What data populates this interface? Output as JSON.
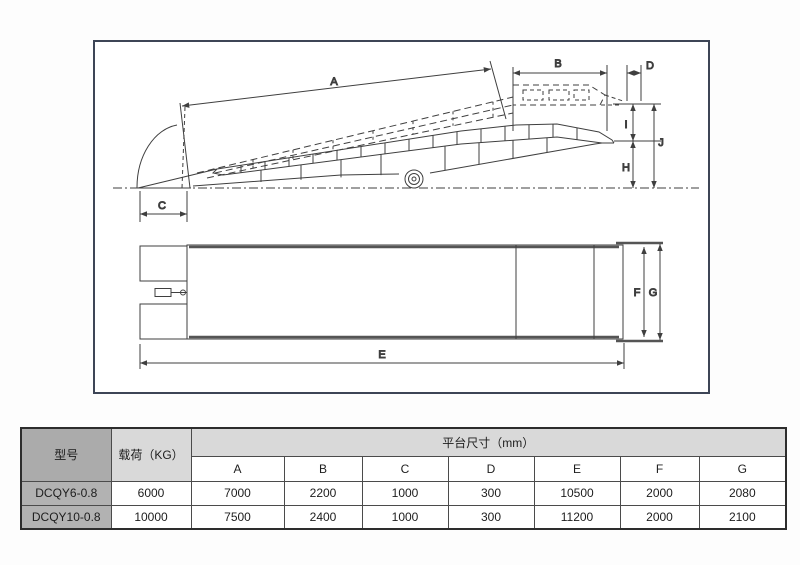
{
  "diagram": {
    "labels": {
      "A": "A",
      "B": "B",
      "C": "C",
      "D": "D",
      "E": "E",
      "F": "F",
      "G": "G",
      "H": "H",
      "I": "I",
      "J": "J"
    }
  },
  "table": {
    "col_model": "型号",
    "col_load": "载荷（KG）",
    "col_platform": "平台尺寸（mm）",
    "dim_headers": [
      "A",
      "B",
      "C",
      "D",
      "E",
      "F",
      "G"
    ],
    "rows": [
      {
        "model": "DCQY6-0.8",
        "load": "6000",
        "dims": [
          "7000",
          "2200",
          "1000",
          "300",
          "10500",
          "2000",
          "2080"
        ]
      },
      {
        "model": "DCQY10-0.8",
        "load": "10000",
        "dims": [
          "7500",
          "2400",
          "1000",
          "300",
          "11200",
          "2000",
          "2100"
        ]
      }
    ]
  },
  "colors": {
    "frame_border": "#3d4556",
    "drawing_line": "#3f3f3f",
    "header_dark_bg": "#ababab",
    "header_light_bg": "#d9d9d9",
    "model_cell_bg": "#b2b2b2",
    "table_border": "#4b4b4b"
  }
}
